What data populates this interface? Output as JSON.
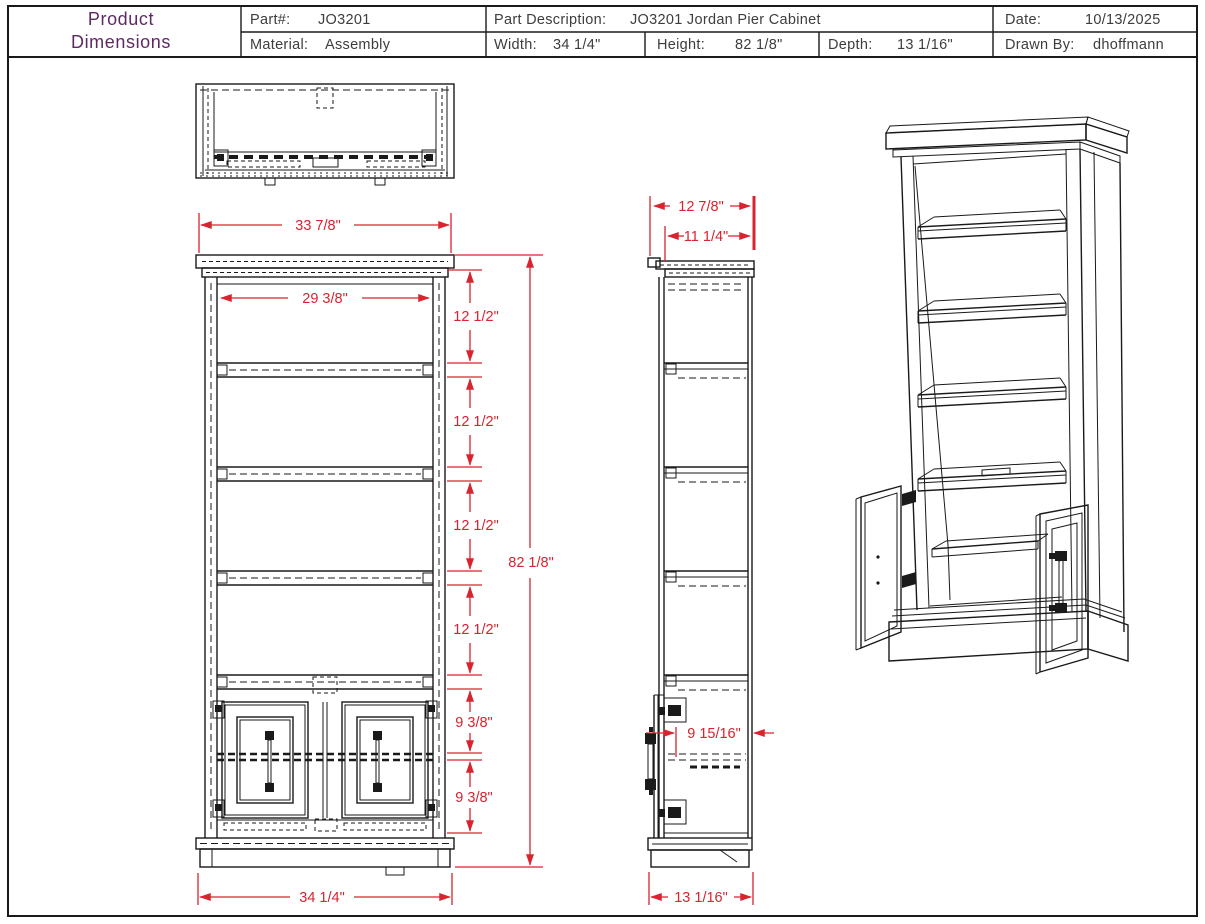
{
  "colors": {
    "line": "#1a1a1a",
    "dimension": "#d9232f",
    "title": "#5e2a63",
    "text": "#3d3d3d",
    "background": "#ffffff"
  },
  "title_block": {
    "title_line1": "Product",
    "title_line2": "Dimensions",
    "part_label": "Part#:",
    "part_value": "JO3201",
    "description_label": "Part Description:",
    "description_value": "JO3201 Jordan Pier Cabinet",
    "date_label": "Date:",
    "date_value": "10/13/2025",
    "material_label": "Material:",
    "material_value": "Assembly",
    "width_label": "Width:",
    "width_value": "34 1/4\"",
    "height_label": "Height:",
    "height_value": "82 1/8\"",
    "depth_label": "Depth:",
    "depth_value": "13 1/16\"",
    "drawn_by_label": "Drawn By:",
    "drawn_by_value": "dhoffmann"
  },
  "views": {
    "front": {
      "dim_top_width": "33 7/8\"",
      "dim_opening_width": "29 3/8\"",
      "dim_shelf_spacing": [
        "12 1/2\"",
        "12 1/2\"",
        "12 1/2\"",
        "12 1/2\""
      ],
      "dim_door_opening": [
        "9 3/8\"",
        "9 3/8\""
      ],
      "dim_total_height": "82 1/8\"",
      "dim_base_width": "34 1/4\""
    },
    "side": {
      "dim_top_depth": "12 7/8\"",
      "dim_body_depth": "11 1/4\"",
      "dim_door_depth": "9 15/16\"",
      "dim_base_depth": "13 1/16\""
    }
  }
}
